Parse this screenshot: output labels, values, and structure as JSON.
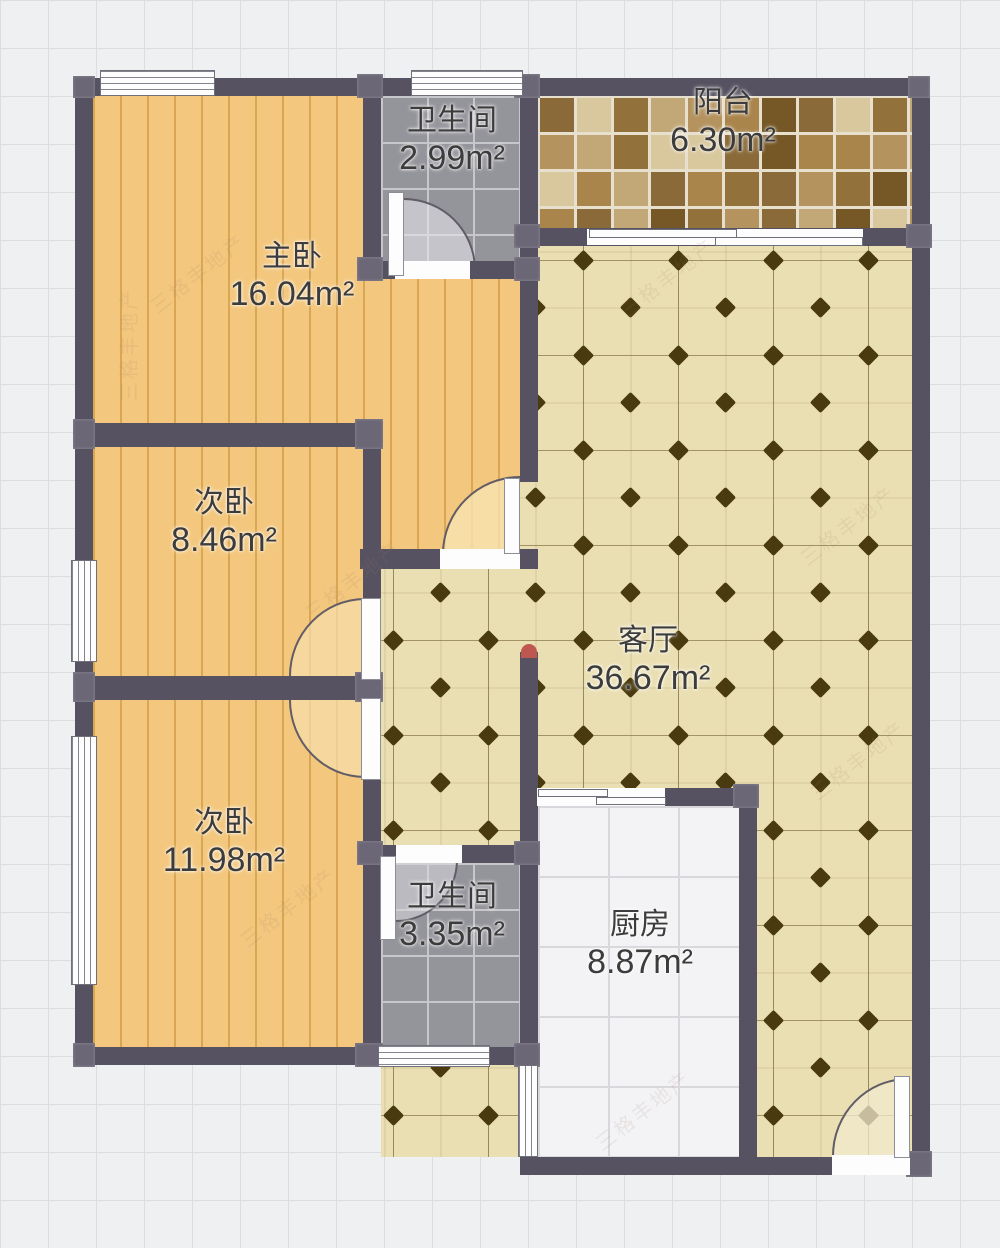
{
  "rooms": [
    {
      "id": "master-bedroom",
      "name": "主卧",
      "area": "16.04m²"
    },
    {
      "id": "bathroom-top",
      "name": "卫生间",
      "area": "2.99m²"
    },
    {
      "id": "balcony",
      "name": "阳台",
      "area": "6.30m²"
    },
    {
      "id": "bedroom-2",
      "name": "次卧",
      "area": "8.46m²"
    },
    {
      "id": "bedroom-3",
      "name": "次卧",
      "area": "11.98m²"
    },
    {
      "id": "living-room",
      "name": "客厅",
      "area": "36.67m²"
    },
    {
      "id": "bathroom-bottom",
      "name": "卫生间",
      "area": "3.35m²"
    },
    {
      "id": "kitchen",
      "name": "厨房",
      "area": "8.87m²"
    }
  ],
  "watermark": "三格丰地产",
  "colors": {
    "wall": "#575261",
    "wall_cap": "#6b6777",
    "red_cap": "#bd574f",
    "wood_floor": "#f3c77d",
    "tile_floor": "#eadfb3",
    "diamond": "#4a3a10",
    "bath_tile": "#94949b",
    "kitchen_tile": "#f3f3f5",
    "mosaic_grout": "#e8e0cf",
    "mosaic_palette": [
      "#8a6a38",
      "#a9854c",
      "#c3a877",
      "#d9c79d",
      "#765726",
      "#b4935f",
      "#93713b"
    ],
    "text": "#3c3c3c"
  }
}
